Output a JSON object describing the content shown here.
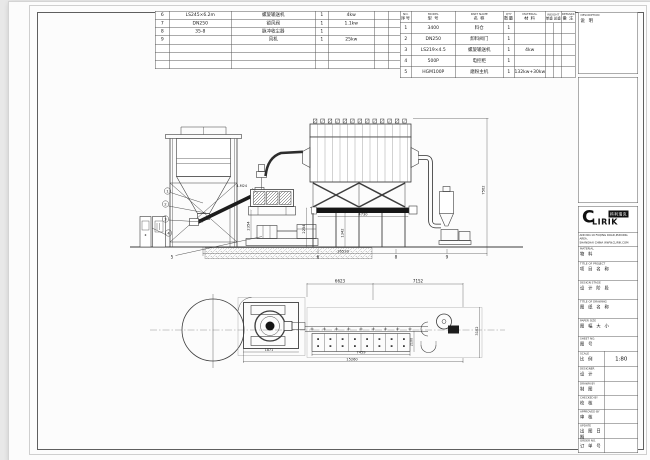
{
  "bom_left": {
    "rows": [
      [
        "6",
        "LS245×6.2m",
        "螺旋输送机",
        "1",
        "4kw",
        "",
        ""
      ],
      [
        "7",
        "DN250",
        "锁风阀",
        "1",
        "1.1kw",
        "",
        ""
      ],
      [
        "8",
        "35-8",
        "脉冲收尘器",
        "1",
        "",
        "",
        ""
      ],
      [
        "9",
        "",
        "风机",
        "1",
        "25kw",
        "",
        ""
      ],
      [
        "",
        "",
        "",
        "",
        "",
        "",
        ""
      ],
      [
        "",
        "",
        "",
        "",
        "",
        "",
        ""
      ],
      [
        "",
        "",
        "",
        "",
        "",
        "",
        ""
      ]
    ]
  },
  "bom_right": {
    "header": {
      "no": {
        "en": "NO.",
        "cn": "序号"
      },
      "model": {
        "en": "MODEL",
        "cn": "型 号"
      },
      "name": {
        "en": "PART NAME",
        "cn": "名 称"
      },
      "qty": {
        "en": "QTY",
        "cn": "数量"
      },
      "material": {
        "en": "MATERIAL",
        "cn": "材 料"
      },
      "weight": {
        "en": "WEIGHT",
        "cn_a": "单重",
        "cn_b": "总重"
      },
      "remark": {
        "en": "REMARK",
        "cn": "备 注"
      }
    },
    "rows": [
      [
        "1",
        "3400",
        "料仓",
        "1",
        "",
        "",
        "",
        ""
      ],
      [
        "2",
        "DN250",
        "卸料阀门",
        "1",
        "",
        "",
        "",
        ""
      ],
      [
        "3",
        "LS219×4.5",
        "螺旋输送机",
        "1",
        "4kw",
        "",
        "",
        ""
      ],
      [
        "4",
        "500P",
        "电控柜",
        "1",
        "",
        "",
        "",
        ""
      ],
      [
        "5",
        "HGM100P",
        "磨粉主机",
        "1",
        "132kw+30kw",
        "",
        "",
        ""
      ]
    ]
  },
  "title_block": {
    "description": {
      "en": "DESCRIPTION",
      "cn": "说 明"
    },
    "logo": {
      "c": "C",
      "rest": "LIRIK",
      "cn": "科利瑞克"
    },
    "address1": "ADD:NO.19 FUQING ROAD,PUDONG AREA,",
    "address2": "SHANGHAI CHINA  WWW.CLIRIK.COM",
    "rows": [
      {
        "en": "MATERIAL",
        "cn": "物 料",
        "value": ""
      },
      {
        "en": "TITLE OF PROJECT",
        "cn": "项 目 名 称",
        "value": ""
      },
      {
        "en": "DESIGN STAGE",
        "cn": "设 计 阶 段",
        "value": ""
      },
      {
        "en": "TITLE OF DRAWING",
        "cn": "图 纸 名 称",
        "value": ""
      },
      {
        "en": "PAPER SIZE",
        "cn": "图 幅 大 小",
        "value": ""
      },
      {
        "en": "SHEET NO.",
        "cn": "图 号",
        "value": ""
      },
      {
        "en": "SCALE",
        "cn": "比 例",
        "value": "1:80"
      },
      {
        "en": "DESIGNER",
        "cn": "设 计",
        "value": ""
      },
      {
        "en": "DRAWN BY",
        "cn": "制 图",
        "value": ""
      },
      {
        "en": "CHECKED BY",
        "cn": "校 核",
        "value": ""
      },
      {
        "en": "APPROVED BY",
        "cn": "审 核",
        "value": ""
      },
      {
        "en": "UPDATE",
        "cn": "出 图 日 期",
        "value": ""
      },
      {
        "en": "ORDER NO.",
        "cn": "订 单 号",
        "value": ""
      }
    ]
  },
  "drawing": {
    "dims": {
      "elev_height": "7562",
      "elev_total": "16520",
      "elev_screw": "4730",
      "elev_h1": "1342",
      "elev_h2": "2254",
      "elev_h3": "2354",
      "plan_d1": "6623",
      "plan_d2": "7152",
      "plan_d3": "7459",
      "plan_d4": "15260",
      "plan_v1": "3102",
      "plan_v2": "2100",
      "plan_mill": "1871"
    },
    "balloons": {
      "b1": "1",
      "b2": "2",
      "b3": "3",
      "b4": "4",
      "b5": "5",
      "b6": "6",
      "b8": "8",
      "b9": "9"
    },
    "note_anchor": "4-M24"
  }
}
